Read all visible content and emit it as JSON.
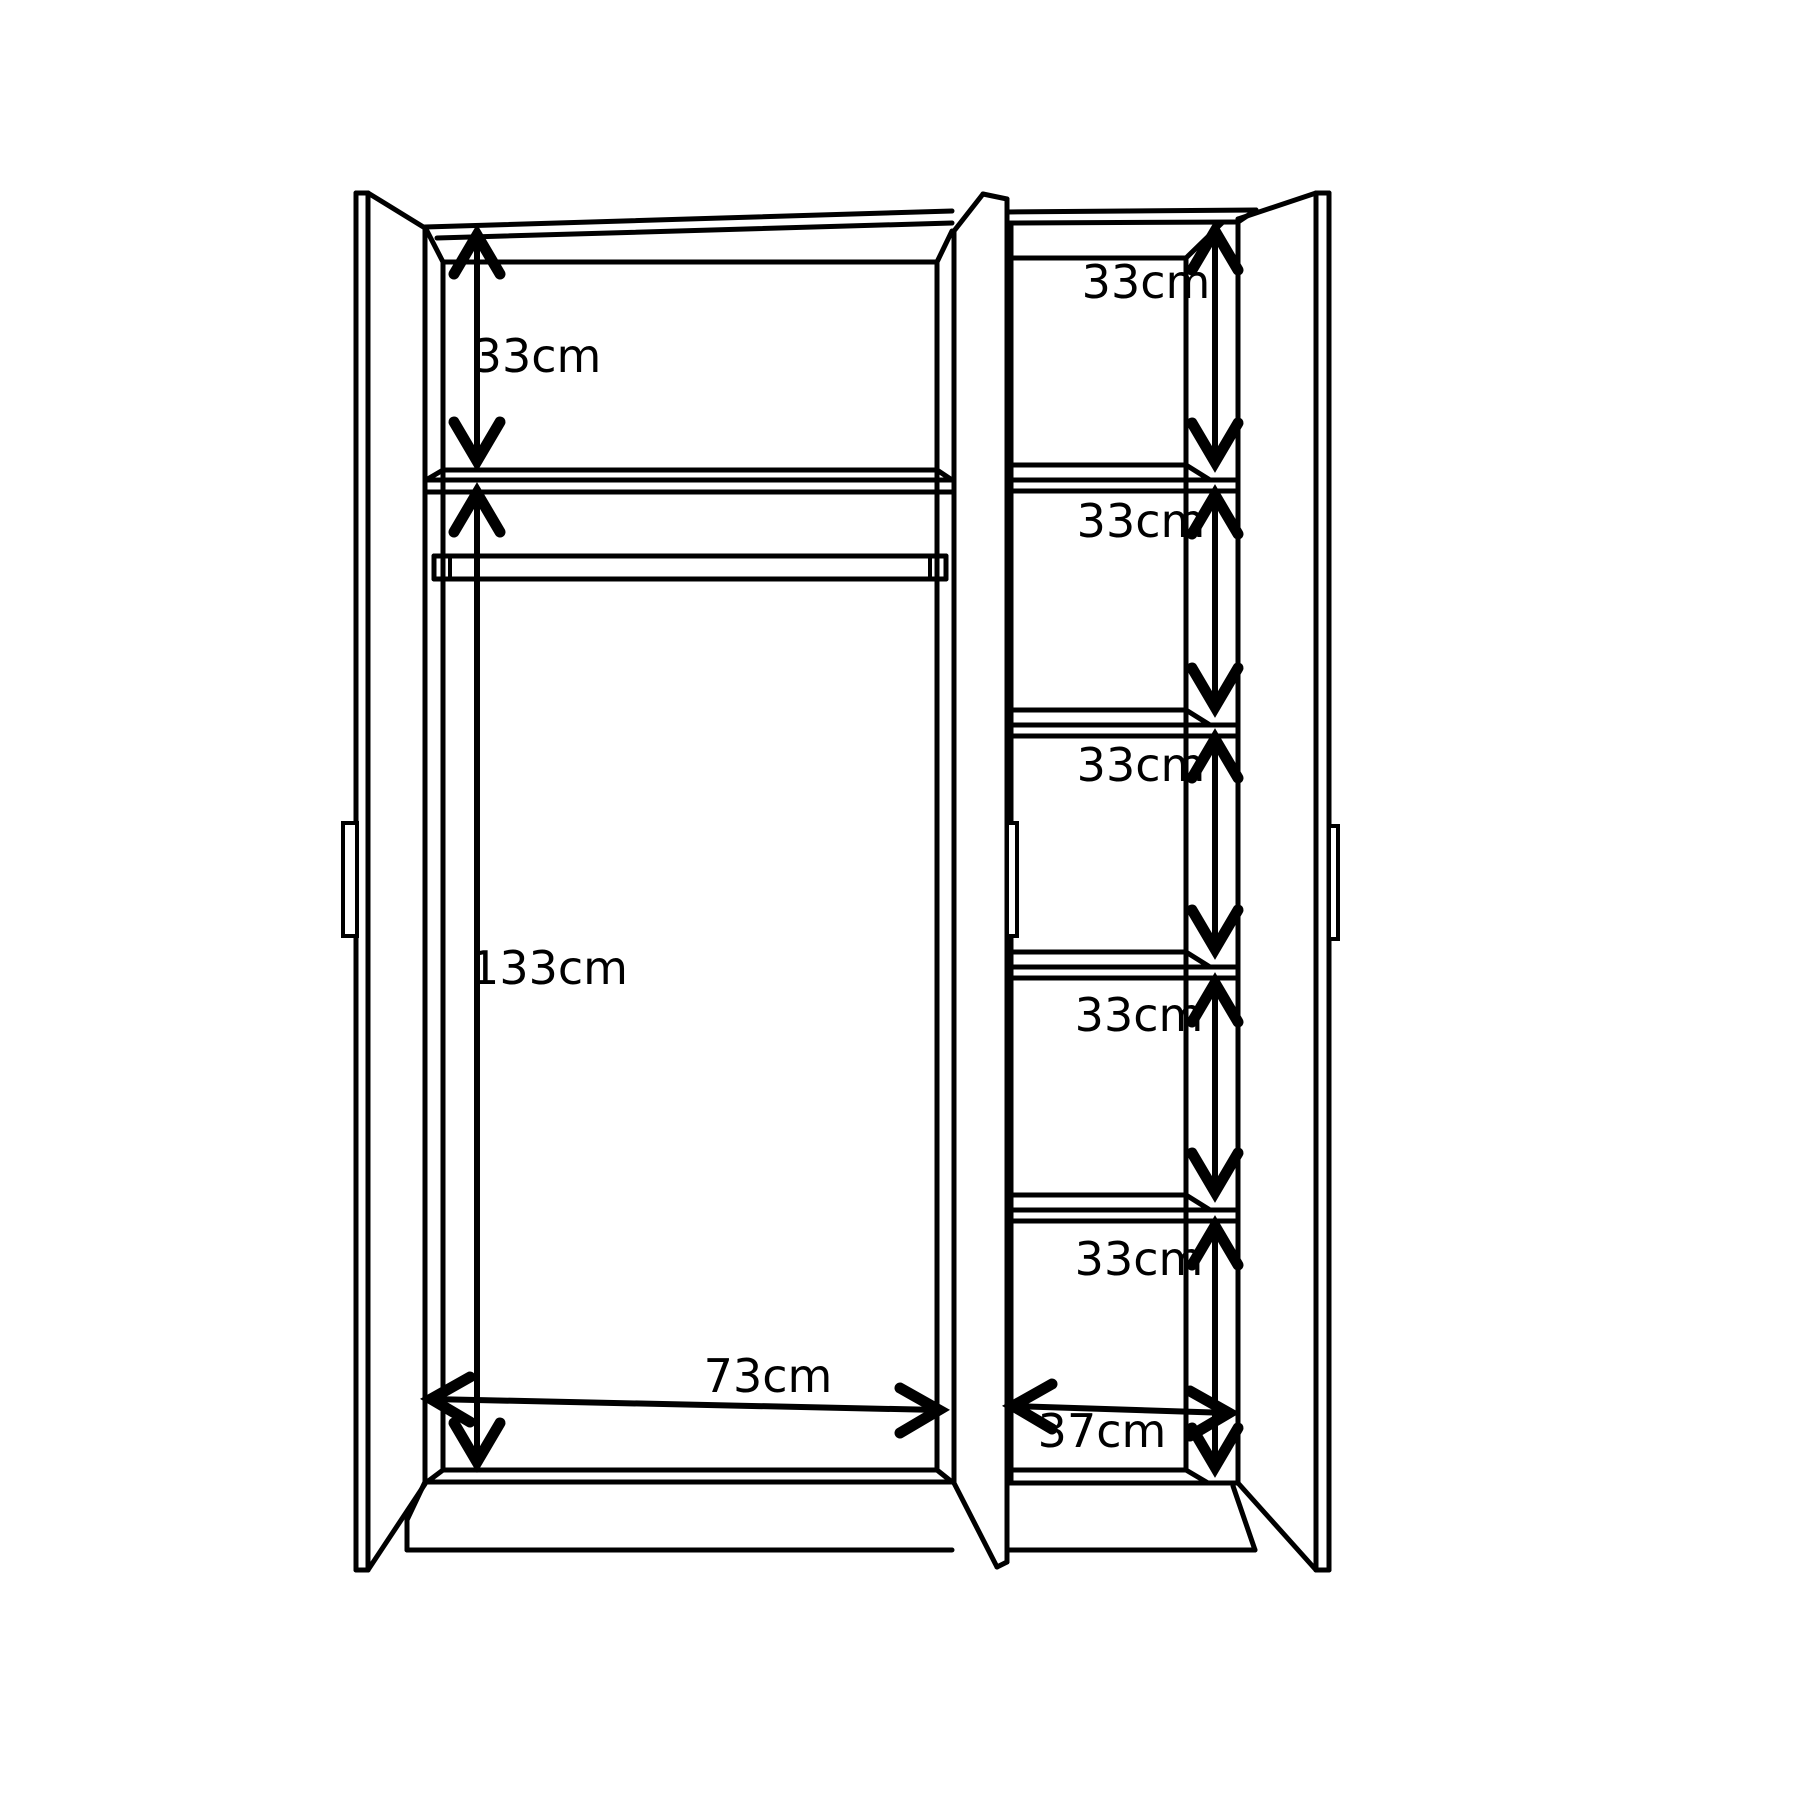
{
  "diagram": {
    "type": "wardrobe-technical-drawing",
    "background_color": "#ffffff",
    "line_color": "#000000",
    "dimensions": {
      "left_top_compartment_height": "33cm",
      "left_hanging_height": "133cm",
      "left_compartment_width": "73cm",
      "right_shelf_1_height": "33cm",
      "right_shelf_2_height": "33cm",
      "right_shelf_3_height": "33cm",
      "right_shelf_4_height": "33cm",
      "right_shelf_5_height": "33cm",
      "right_compartment_width": "37cm"
    }
  }
}
